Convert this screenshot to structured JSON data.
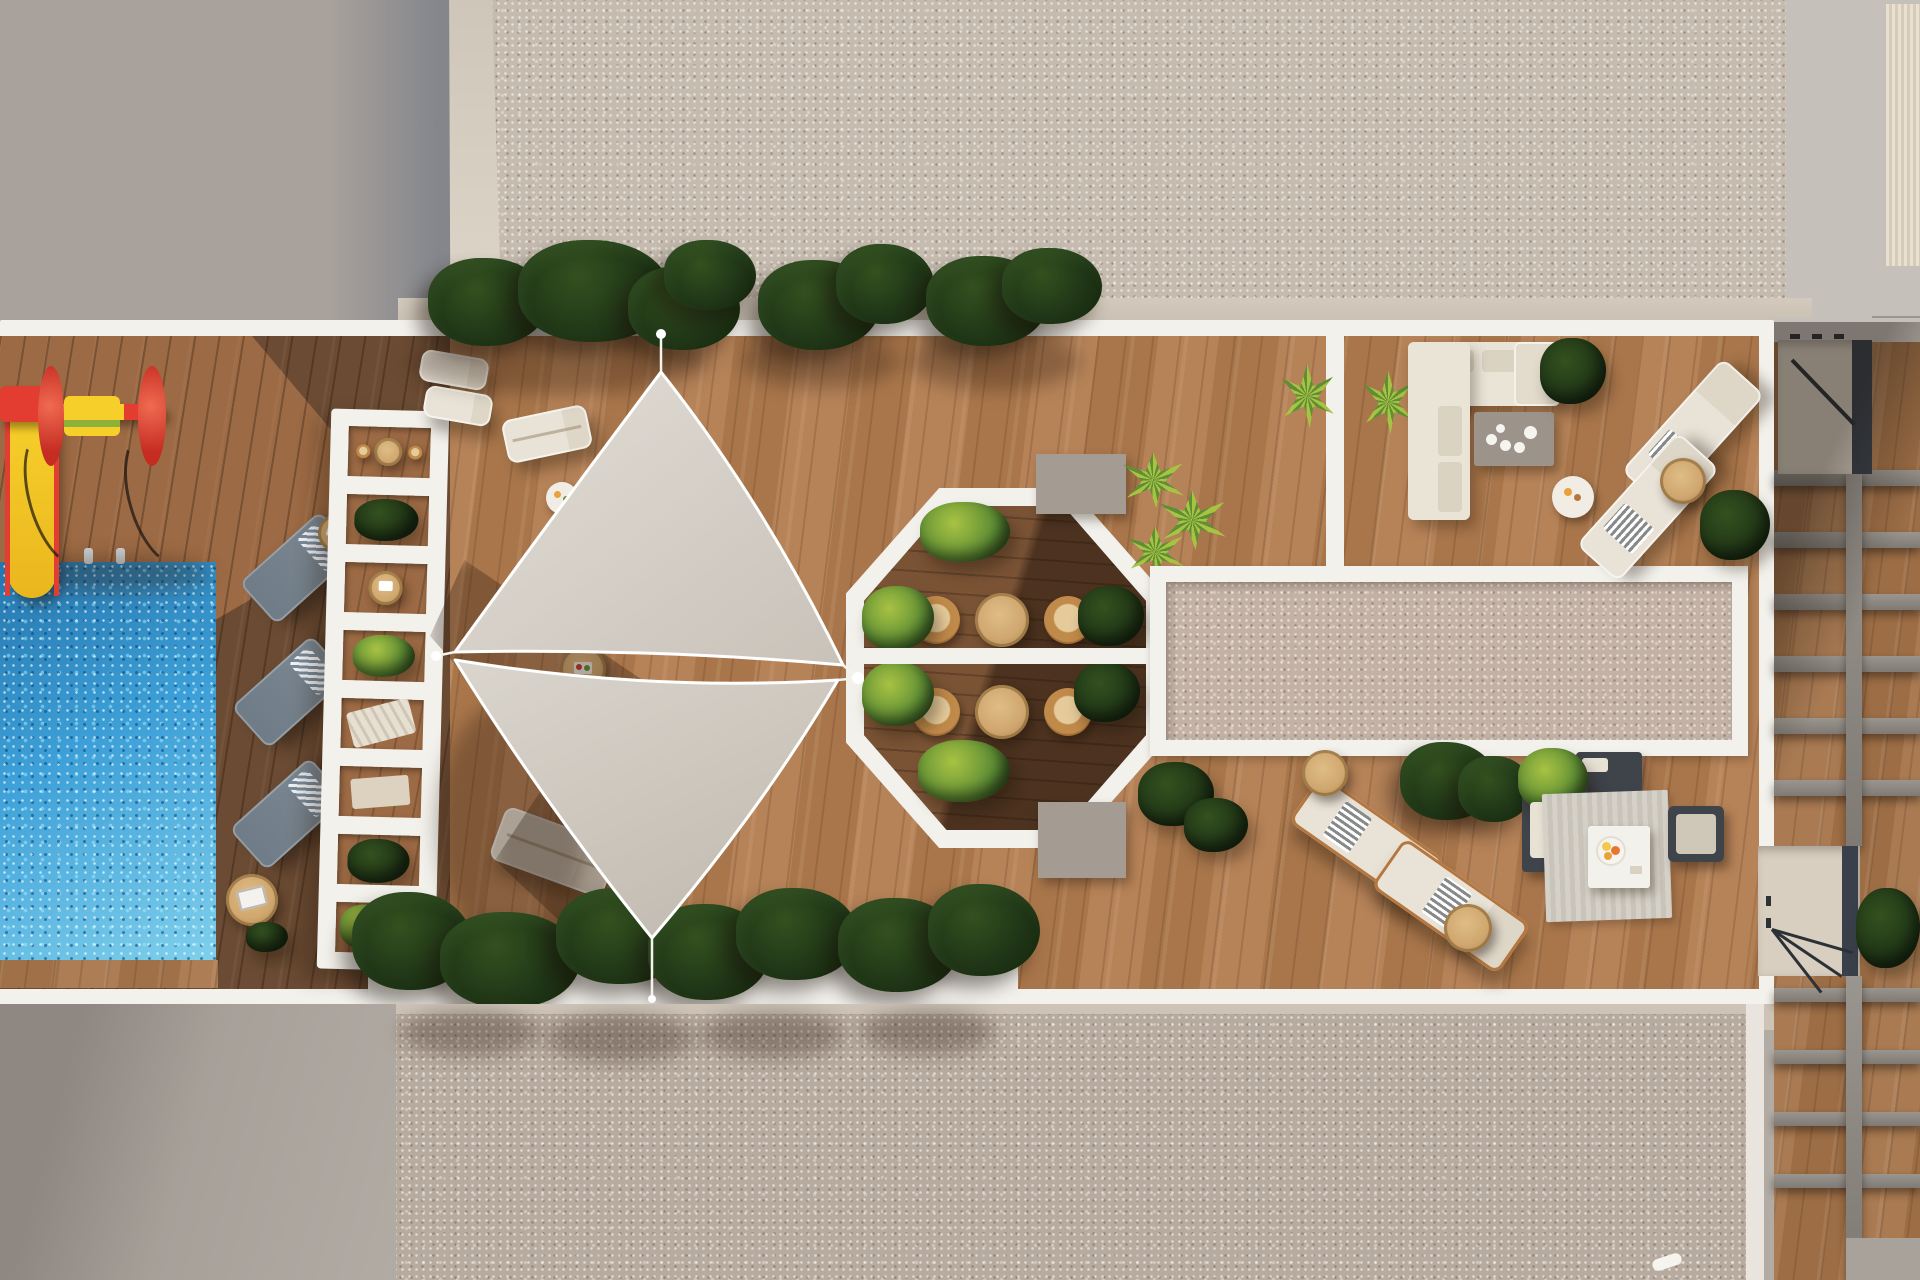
{
  "scene": {
    "type": "architectural-render",
    "view": "top-down-aerial",
    "subject": "rooftop amenity terrace of a residential building with pool, playground, shade sails, octagonal seating nook and lounge areas",
    "text_content": "none"
  },
  "palette": {
    "bg": "#b3aca5",
    "concrete_tl": "#a9a29c",
    "wall_shadow": "#84868c",
    "cream_strip": "#d6cdc0",
    "concrete_tr": "#c6c0ba",
    "stripe_light": "#e9e0d0",
    "stripe_dark": "#d6cbb8",
    "gravel_top": "#c6bbaf",
    "gravel_mid": "#c2b1a4",
    "gravel_bottom": "#b7aa9e",
    "concrete_bottom": "#a7a099",
    "white": "#f3f1ec",
    "beige_strip": "#cdc4b7",
    "wood_lit": "#b27c4f",
    "wood_left": "#6b4b33",
    "wood_left_lit": "#9c6a44",
    "wood_right": "#a5744a",
    "octagon_wood": "#7a5335",
    "pool_deep": "#2576ad",
    "pool_main": "#3da0d8",
    "pool_light": "#7fd0ec",
    "sail": "#e2ddd6",
    "sail_dark": "#c8c2b9",
    "rope": "#f5f3ee",
    "plant_dark": "#1d3115",
    "plant_mid": "#33511f",
    "plant_bright": "#5f8f35",
    "yucca_light": "#a8c243",
    "lounger_slate": "#7c8892",
    "lounger_cream": "#e9e3d7",
    "copper": "#b5773f",
    "rattan": "#c08a4a",
    "table_wood": "#cfa76f",
    "sofa_cream": "#eae4d7",
    "cushion_shade": "#dbd3c2",
    "table_gray": "#9c948a",
    "charcoal": "#3f434a",
    "rug": "#d6d1c8",
    "beam_gray": "#918c86",
    "stair_floor": "#d9cfc1",
    "stair_dark": "#394049",
    "slide_red": "#e23d30",
    "slide_yellow": "#f6cf2a",
    "shadow": "rgba(45,28,14,0.33)"
  },
  "objects": {
    "areas": [
      "concrete-roof-top-left",
      "gravel-roof-top",
      "kids-playground",
      "swimming-pool",
      "pool-lounger-row",
      "white-pergola-planter",
      "shade-sail-deck",
      "octagonal-seating-nook",
      "gravel-skylight-panel",
      "outdoor-living-room",
      "right-lounger-pair",
      "dining-corner",
      "planter-box-row",
      "gravel-roof-bottom",
      "neighbor-rooftop-with-stairs"
    ],
    "counts": {
      "shade_sails": 2,
      "sun_loungers_slate": 3,
      "sun_loungers_cream": 8,
      "bistro_chairs": 4,
      "bistro_tables": 2,
      "tree_clusters_top": 3,
      "planter_clusters_bottom": 6,
      "stair_openings": 2,
      "playground_pieces": 2
    }
  }
}
